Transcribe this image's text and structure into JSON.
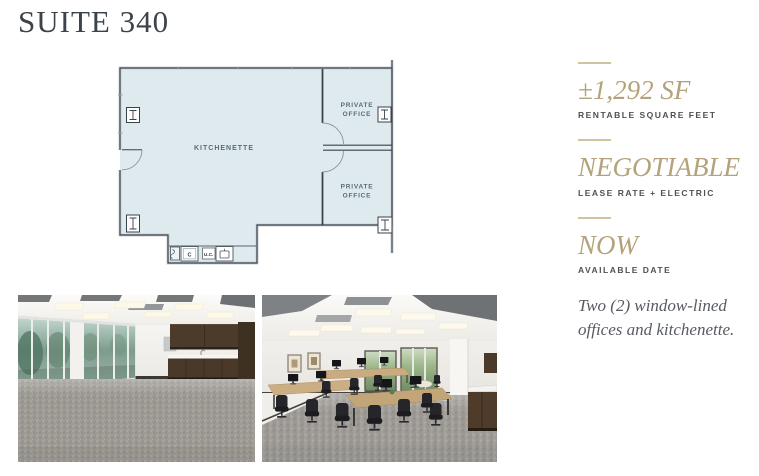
{
  "page": {
    "title": "SUITE 340"
  },
  "floor_plan": {
    "labels": {
      "kitchenette": "KITCHENETTE",
      "office_line1": "PRIVATE",
      "office_line2": "OFFICE",
      "under_counter": "U.C.",
      "cabinet": "C"
    },
    "colors": {
      "fill": "#dfeaef",
      "wall": "#39434b",
      "outer_band": "#c9d0d4",
      "label": "#5b6b77"
    }
  },
  "stats": [
    {
      "value": "±1,292 SF",
      "label": "RENTABLE SQUARE FEET"
    },
    {
      "value": "NEGOTIABLE",
      "label": "LEASE RATE + ELECTRIC"
    },
    {
      "value": "NOW",
      "label": "AVAILABLE DATE"
    }
  ],
  "description": "Two (2) window-lined offices and kitchenette.",
  "theme": {
    "accent_gold": "#b4a37a",
    "divider_gold": "#cfc3a0",
    "title_color": "#3d434a",
    "label_gray": "#4d5154",
    "body_gray": "#565b61",
    "background": "#ffffff"
  }
}
